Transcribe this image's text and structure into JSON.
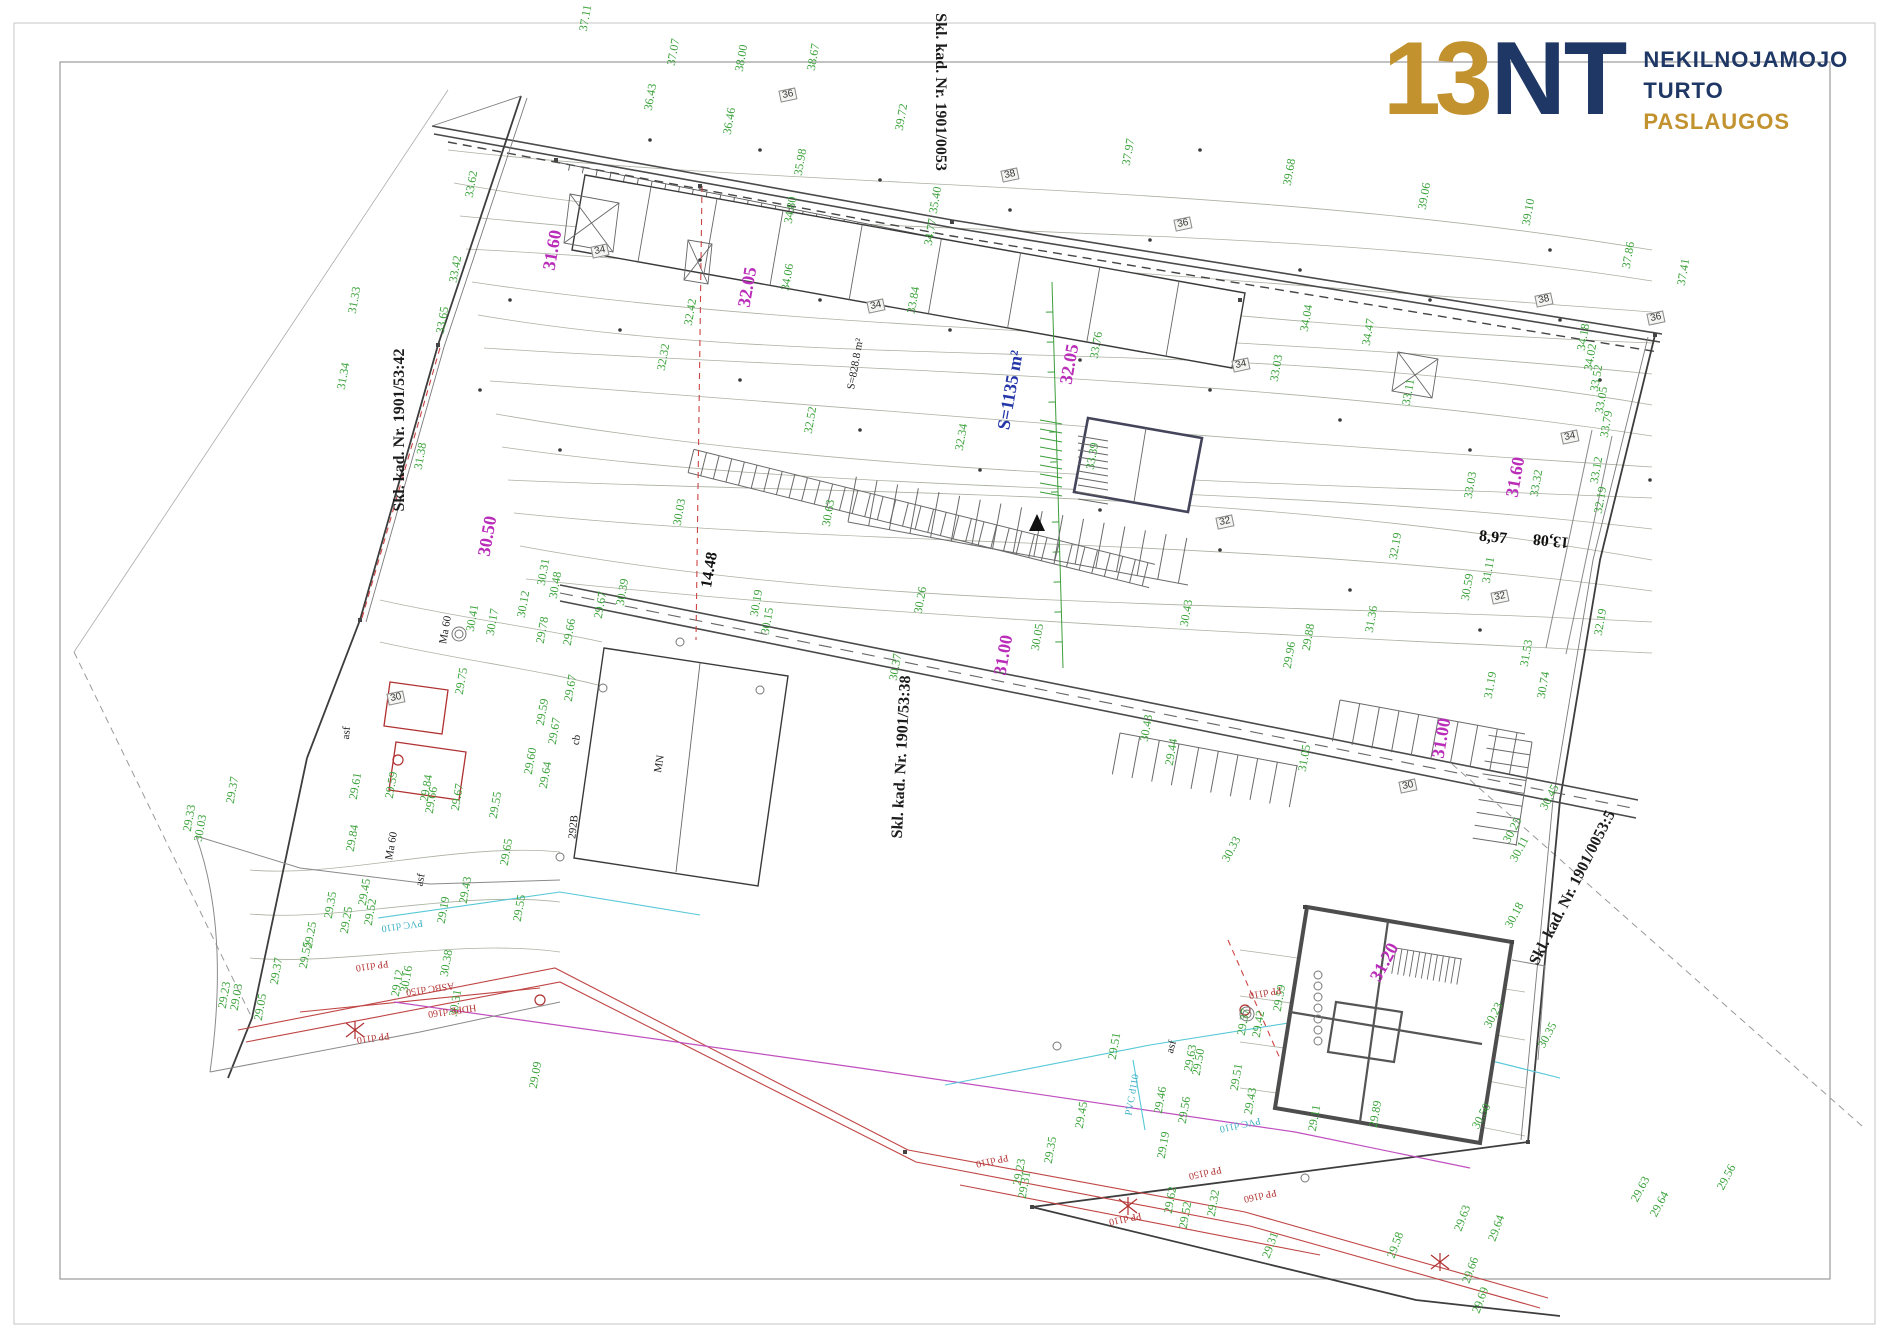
{
  "logo": {
    "digits": "13",
    "letters": "NT",
    "line1": "NEKILNOJAMOJO",
    "line2": "TURTO",
    "line3": "PASLAUGOS"
  },
  "colors": {
    "gold": "#c2922f",
    "navy": "#1f3764",
    "green": "#3aa23a",
    "magenta": "#b92db9",
    "blue": "#2436a8",
    "red": "#b23333",
    "cyan": "#3ab0c4"
  },
  "labels": [
    {
      "t": "Skl. kad. Nr. 1901/53:42",
      "x": 400,
      "y": 430,
      "r": -90,
      "c": "k"
    },
    {
      "t": "Skl. kad. Nr. 1901/0053",
      "x": 940,
      "y": 92,
      "r": 90,
      "c": "k"
    },
    {
      "t": "Skl. kad. Nr. 1901/53:38",
      "x": 902,
      "y": 757,
      "r": -87,
      "c": "k"
    },
    {
      "t": "Skl. kad. Nr. 1901/0053:5",
      "x": 1573,
      "y": 888,
      "r": -63,
      "c": "k"
    },
    {
      "t": "31.60",
      "x": 552,
      "y": 250,
      "c": "m"
    },
    {
      "t": "32.05",
      "x": 747,
      "y": 287,
      "c": "m"
    },
    {
      "t": "30.50",
      "x": 487,
      "y": 536,
      "c": "m"
    },
    {
      "t": "32.05",
      "x": 1069,
      "y": 364,
      "c": "m"
    },
    {
      "t": "31.60",
      "x": 1515,
      "y": 477,
      "c": "m"
    },
    {
      "t": "31.00",
      "x": 1003,
      "y": 655,
      "c": "m"
    },
    {
      "t": "31.00",
      "x": 1441,
      "y": 738,
      "c": "m"
    },
    {
      "t": "31.20",
      "x": 1384,
      "y": 962,
      "r": -62,
      "c": "m"
    },
    {
      "t": "S=1135 m²",
      "x": 1010,
      "y": 390,
      "c": "b"
    },
    {
      "t": "14.48",
      "x": 710,
      "y": 570,
      "r": -80,
      "c": "d"
    },
    {
      "t": "8,97",
      "x": 1493,
      "y": 538,
      "r": 6,
      "c": "d"
    },
    {
      "t": "13,08",
      "x": 1551,
      "y": 540,
      "r": 186,
      "c": "d"
    },
    {
      "t": "MN",
      "x": 660,
      "y": 764,
      "c": "s"
    },
    {
      "t": "292B",
      "x": 574,
      "y": 827,
      "r": -84,
      "c": "s"
    },
    {
      "t": "cb",
      "x": 577,
      "y": 740,
      "c": "s"
    },
    {
      "t": "asf",
      "x": 347,
      "y": 733,
      "r": -85,
      "c": "s"
    },
    {
      "t": "asf",
      "x": 421,
      "y": 880,
      "c": "s"
    },
    {
      "t": "asf",
      "x": 1172,
      "y": 1047,
      "r": -75,
      "c": "s"
    },
    {
      "t": "Ma 60",
      "x": 446,
      "y": 630,
      "c": "s"
    },
    {
      "t": "Ma 60",
      "x": 392,
      "y": 846,
      "c": "s"
    },
    {
      "t": "S=828.8 m²",
      "x": 856,
      "y": 364,
      "c": "s"
    },
    {
      "t": "34",
      "x": 600,
      "y": 251,
      "c": "x"
    },
    {
      "t": "34",
      "x": 876,
      "y": 306,
      "c": "x"
    },
    {
      "t": "34",
      "x": 1241,
      "y": 365,
      "c": "x"
    },
    {
      "t": "34",
      "x": 1570,
      "y": 437,
      "c": "x"
    },
    {
      "t": "36",
      "x": 788,
      "y": 95,
      "c": "x"
    },
    {
      "t": "36",
      "x": 1183,
      "y": 224,
      "c": "x"
    },
    {
      "t": "36",
      "x": 1656,
      "y": 318,
      "c": "x"
    },
    {
      "t": "38",
      "x": 1010,
      "y": 175,
      "c": "x"
    },
    {
      "t": "38",
      "x": 1544,
      "y": 300,
      "c": "x"
    },
    {
      "t": "32",
      "x": 1225,
      "y": 522,
      "c": "x"
    },
    {
      "t": "32",
      "x": 1500,
      "y": 597,
      "c": "x"
    },
    {
      "t": "30",
      "x": 396,
      "y": 698,
      "c": "x"
    },
    {
      "t": "30",
      "x": 1408,
      "y": 786,
      "c": "x"
    },
    {
      "t": "37.11",
      "x": 585,
      "y": 18
    },
    {
      "t": "37.07",
      "x": 673,
      "y": 52
    },
    {
      "t": "38.00",
      "x": 741,
      "y": 58
    },
    {
      "t": "38.67",
      "x": 813,
      "y": 57
    },
    {
      "t": "36.43",
      "x": 650,
      "y": 97
    },
    {
      "t": "36.46",
      "x": 729,
      "y": 121
    },
    {
      "t": "39.72",
      "x": 901,
      "y": 117
    },
    {
      "t": "37.97",
      "x": 1128,
      "y": 152
    },
    {
      "t": "39.68",
      "x": 1289,
      "y": 172
    },
    {
      "t": "39.06",
      "x": 1424,
      "y": 196
    },
    {
      "t": "39.10",
      "x": 1528,
      "y": 212
    },
    {
      "t": "37.86",
      "x": 1628,
      "y": 255
    },
    {
      "t": "37.41",
      "x": 1683,
      "y": 272
    },
    {
      "t": "35.98",
      "x": 800,
      "y": 162
    },
    {
      "t": "34.80",
      "x": 790,
      "y": 210
    },
    {
      "t": "35.40",
      "x": 935,
      "y": 200
    },
    {
      "t": "34.77",
      "x": 930,
      "y": 232
    },
    {
      "t": "33.62",
      "x": 471,
      "y": 184
    },
    {
      "t": "33.42",
      "x": 455,
      "y": 269
    },
    {
      "t": "31.33",
      "x": 354,
      "y": 300
    },
    {
      "t": "31.34",
      "x": 343,
      "y": 376
    },
    {
      "t": "33.65",
      "x": 442,
      "y": 320
    },
    {
      "t": "31.38",
      "x": 420,
      "y": 456
    },
    {
      "t": "32.42",
      "x": 690,
      "y": 312
    },
    {
      "t": "32.32",
      "x": 663,
      "y": 357
    },
    {
      "t": "34.06",
      "x": 787,
      "y": 277
    },
    {
      "t": "33.84",
      "x": 913,
      "y": 300
    },
    {
      "t": "33.76",
      "x": 1096,
      "y": 345
    },
    {
      "t": "32.34",
      "x": 961,
      "y": 437
    },
    {
      "t": "33.39",
      "x": 1092,
      "y": 456
    },
    {
      "t": "32.52",
      "x": 810,
      "y": 420
    },
    {
      "t": "34.04",
      "x": 1306,
      "y": 318
    },
    {
      "t": "34.47",
      "x": 1368,
      "y": 332
    },
    {
      "t": "33.03",
      "x": 1276,
      "y": 368
    },
    {
      "t": "33.11",
      "x": 1408,
      "y": 392
    },
    {
      "t": "32.19",
      "x": 1395,
      "y": 546
    },
    {
      "t": "31.11",
      "x": 1488,
      "y": 570
    },
    {
      "t": "33.03",
      "x": 1470,
      "y": 485
    },
    {
      "t": "33.32",
      "x": 1536,
      "y": 483
    },
    {
      "t": "34.18",
      "x": 1583,
      "y": 337
    },
    {
      "t": "34.02",
      "x": 1590,
      "y": 357
    },
    {
      "t": "33.52",
      "x": 1596,
      "y": 378
    },
    {
      "t": "33.05",
      "x": 1601,
      "y": 400
    },
    {
      "t": "33.79",
      "x": 1606,
      "y": 424
    },
    {
      "t": "33.12",
      "x": 1596,
      "y": 470
    },
    {
      "t": "32.19",
      "x": 1600,
      "y": 500
    },
    {
      "t": "32.19",
      "x": 1600,
      "y": 622
    },
    {
      "t": "30.59",
      "x": 1467,
      "y": 587
    },
    {
      "t": "30.63",
      "x": 828,
      "y": 513
    },
    {
      "t": "30.03",
      "x": 679,
      "y": 512
    },
    {
      "t": "30.19",
      "x": 756,
      "y": 603
    },
    {
      "t": "30.15",
      "x": 767,
      "y": 621
    },
    {
      "t": "30.26",
      "x": 920,
      "y": 600
    },
    {
      "t": "30.37",
      "x": 895,
      "y": 667
    },
    {
      "t": "30.43",
      "x": 1186,
      "y": 613
    },
    {
      "t": "30.05",
      "x": 1037,
      "y": 637
    },
    {
      "t": "31.36",
      "x": 1371,
      "y": 619
    },
    {
      "t": "31.53",
      "x": 1526,
      "y": 653
    },
    {
      "t": "31.19",
      "x": 1490,
      "y": 685
    },
    {
      "t": "30.74",
      "x": 1543,
      "y": 685
    },
    {
      "t": "29.96",
      "x": 1289,
      "y": 655
    },
    {
      "t": "29.88",
      "x": 1308,
      "y": 637
    },
    {
      "t": "30.43",
      "x": 1146,
      "y": 728
    },
    {
      "t": "29.44",
      "x": 1171,
      "y": 752
    },
    {
      "t": "31.05",
      "x": 1304,
      "y": 758
    },
    {
      "t": "30.45",
      "x": 1549,
      "y": 797,
      "r": -62
    },
    {
      "t": "30.11",
      "x": 1519,
      "y": 849,
      "r": -62
    },
    {
      "t": "30.25",
      "x": 1512,
      "y": 830,
      "r": -62
    },
    {
      "t": "30.33",
      "x": 1231,
      "y": 849,
      "r": -62
    },
    {
      "t": "30.12",
      "x": 523,
      "y": 604
    },
    {
      "t": "30.31",
      "x": 543,
      "y": 572
    },
    {
      "t": "30.48",
      "x": 555,
      "y": 585
    },
    {
      "t": "30.39",
      "x": 622,
      "y": 592
    },
    {
      "t": "30.41",
      "x": 472,
      "y": 618
    },
    {
      "t": "30.17",
      "x": 492,
      "y": 622
    },
    {
      "t": "29.67",
      "x": 600,
      "y": 605
    },
    {
      "t": "29.78",
      "x": 542,
      "y": 630
    },
    {
      "t": "29.66",
      "x": 569,
      "y": 632
    },
    {
      "t": "29.75",
      "x": 461,
      "y": 681
    },
    {
      "t": "29.67",
      "x": 570,
      "y": 688
    },
    {
      "t": "29.59",
      "x": 542,
      "y": 712
    },
    {
      "t": "29.67",
      "x": 554,
      "y": 731
    },
    {
      "t": "29.60",
      "x": 530,
      "y": 761
    },
    {
      "t": "29.64",
      "x": 545,
      "y": 775
    },
    {
      "t": "29.84",
      "x": 426,
      "y": 788
    },
    {
      "t": "29.66",
      "x": 431,
      "y": 800
    },
    {
      "t": "29.67",
      "x": 457,
      "y": 797
    },
    {
      "t": "29.55",
      "x": 495,
      "y": 805
    },
    {
      "t": "29.61",
      "x": 355,
      "y": 786
    },
    {
      "t": "29.59",
      "x": 391,
      "y": 785
    },
    {
      "t": "29.84",
      "x": 352,
      "y": 838
    },
    {
      "t": "29.65",
      "x": 506,
      "y": 852
    },
    {
      "t": "29.25",
      "x": 310,
      "y": 935
    },
    {
      "t": "29.55",
      "x": 305,
      "y": 955
    },
    {
      "t": "29.35",
      "x": 330,
      "y": 905
    },
    {
      "t": "29.25",
      "x": 346,
      "y": 920
    },
    {
      "t": "29.45",
      "x": 364,
      "y": 892
    },
    {
      "t": "29.52",
      "x": 370,
      "y": 912
    },
    {
      "t": "29.37",
      "x": 276,
      "y": 971
    },
    {
      "t": "29.23",
      "x": 224,
      "y": 995
    },
    {
      "t": "29.03",
      "x": 236,
      "y": 997
    },
    {
      "t": "29.05",
      "x": 260,
      "y": 1007
    },
    {
      "t": "29.12",
      "x": 397,
      "y": 983
    },
    {
      "t": "30.16",
      "x": 406,
      "y": 979
    },
    {
      "t": "29.19",
      "x": 443,
      "y": 910
    },
    {
      "t": "29.43",
      "x": 465,
      "y": 890
    },
    {
      "t": "29.55",
      "x": 519,
      "y": 908
    },
    {
      "t": "30.31",
      "x": 455,
      "y": 1003
    },
    {
      "t": "30.38",
      "x": 446,
      "y": 963
    },
    {
      "t": "29.33",
      "x": 189,
      "y": 818
    },
    {
      "t": "30.03",
      "x": 200,
      "y": 828
    },
    {
      "t": "29.37",
      "x": 232,
      "y": 790
    },
    {
      "t": "29.09",
      "x": 535,
      "y": 1075
    },
    {
      "t": "29.51",
      "x": 1114,
      "y": 1046
    },
    {
      "t": "29.63",
      "x": 1190,
      "y": 1058
    },
    {
      "t": "29.50",
      "x": 1198,
      "y": 1062
    },
    {
      "t": "29.37",
      "x": 1243,
      "y": 1022
    },
    {
      "t": "29.42",
      "x": 1258,
      "y": 1024
    },
    {
      "t": "29.59",
      "x": 1279,
      "y": 998
    },
    {
      "t": "29.51",
      "x": 1236,
      "y": 1077
    },
    {
      "t": "29.43",
      "x": 1250,
      "y": 1101
    },
    {
      "t": "29.46",
      "x": 1160,
      "y": 1100
    },
    {
      "t": "29.56",
      "x": 1184,
      "y": 1110
    },
    {
      "t": "29.19",
      "x": 1163,
      "y": 1145
    },
    {
      "t": "29.45",
      "x": 1081,
      "y": 1115
    },
    {
      "t": "29.35",
      "x": 1050,
      "y": 1150
    },
    {
      "t": "29.31",
      "x": 1024,
      "y": 1185
    },
    {
      "t": "29.23",
      "x": 1019,
      "y": 1172
    },
    {
      "t": "29.62",
      "x": 1170,
      "y": 1200
    },
    {
      "t": "29.52",
      "x": 1185,
      "y": 1215
    },
    {
      "t": "29.32",
      "x": 1213,
      "y": 1203
    },
    {
      "t": "29.31",
      "x": 1270,
      "y": 1245,
      "r": -70
    },
    {
      "t": "29.58",
      "x": 1395,
      "y": 1245,
      "r": -70
    },
    {
      "t": "29.63",
      "x": 1462,
      "y": 1218,
      "r": -70
    },
    {
      "t": "29.64",
      "x": 1496,
      "y": 1228,
      "r": -70
    },
    {
      "t": "29.66",
      "x": 1470,
      "y": 1270,
      "r": -70
    },
    {
      "t": "29.69",
      "x": 1480,
      "y": 1300,
      "r": -70
    },
    {
      "t": "29.56",
      "x": 1726,
      "y": 1177,
      "r": -62
    },
    {
      "t": "29.64",
      "x": 1659,
      "y": 1204,
      "r": -62
    },
    {
      "t": "29.63",
      "x": 1640,
      "y": 1189,
      "r": -62
    },
    {
      "t": "30.18",
      "x": 1514,
      "y": 915,
      "r": -62
    },
    {
      "t": "30.23",
      "x": 1493,
      "y": 1015,
      "r": -62
    },
    {
      "t": "30.50",
      "x": 1481,
      "y": 1116,
      "r": -62
    },
    {
      "t": "30.35",
      "x": 1547,
      "y": 1035,
      "r": -62
    },
    {
      "t": "29.89",
      "x": 1375,
      "y": 1114
    },
    {
      "t": "29.11",
      "x": 1314,
      "y": 1118
    },
    {
      "t": "PP d110",
      "x": 372,
      "y": 965,
      "c": "r"
    },
    {
      "t": "ASBC d150",
      "x": 430,
      "y": 988,
      "c": "r"
    },
    {
      "t": "PP d110",
      "x": 373,
      "y": 1037,
      "c": "r"
    },
    {
      "t": "HDPE d160",
      "x": 452,
      "y": 1010,
      "c": "r"
    },
    {
      "t": "PP d110",
      "x": 1265,
      "y": 992,
      "r": 170,
      "c": "r"
    },
    {
      "t": "PP d150",
      "x": 1205,
      "y": 1172,
      "r": 168,
      "c": "r"
    },
    {
      "t": "PP d110",
      "x": 1125,
      "y": 1218,
      "r": 168,
      "c": "r"
    },
    {
      "t": "PP d160",
      "x": 1260,
      "y": 1195,
      "r": 168,
      "c": "r"
    },
    {
      "t": "PP d110",
      "x": 992,
      "y": 1160,
      "r": 168,
      "c": "r"
    },
    {
      "t": "PVC d110",
      "x": 402,
      "y": 925,
      "c": "c"
    },
    {
      "t": "PVC d110",
      "x": 1240,
      "y": 1124,
      "r": 168,
      "c": "c"
    },
    {
      "t": "PVC d110",
      "x": 1133,
      "y": 1095,
      "r": -80,
      "c": "c"
    }
  ]
}
